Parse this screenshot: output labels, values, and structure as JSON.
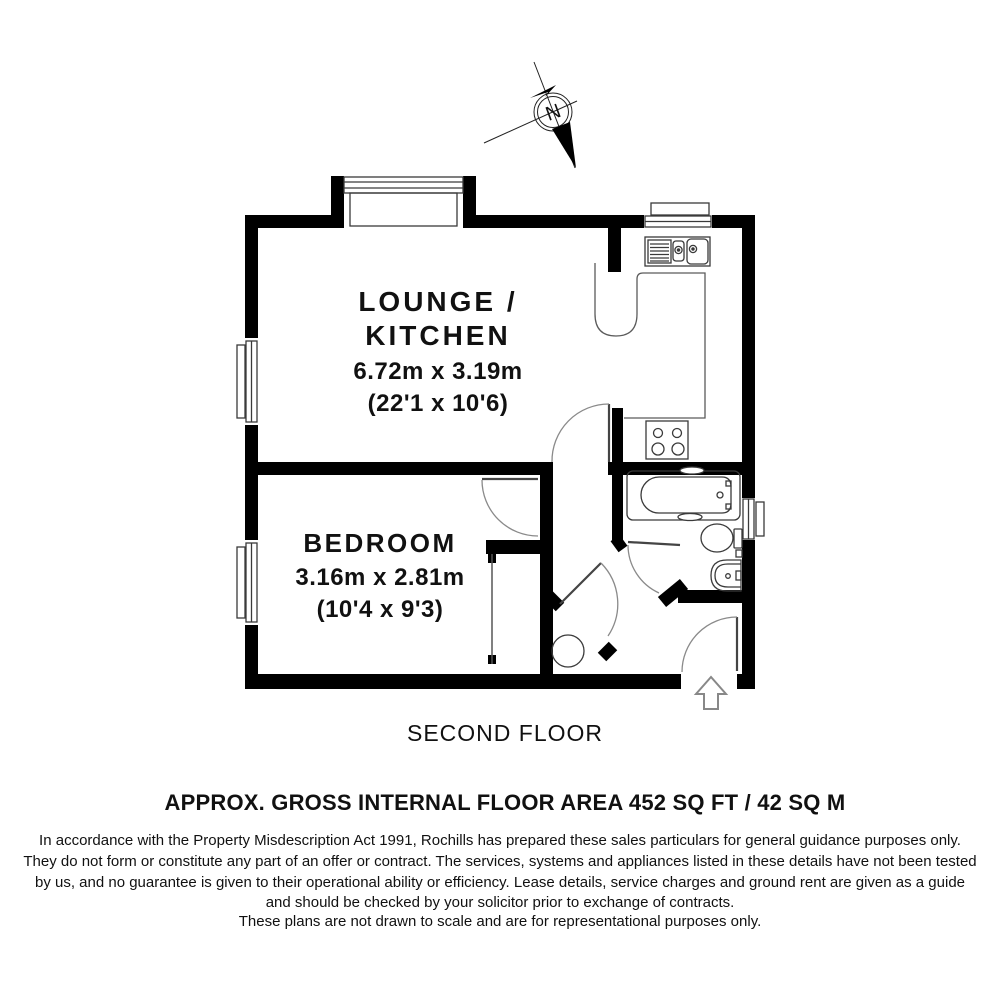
{
  "compass": {
    "north_label": "N"
  },
  "plan": {
    "rooms": {
      "lounge_kitchen": {
        "label_line1": "LOUNGE /",
        "label_line2": "KITCHEN",
        "dimensions_metric": "6.72m x 3.19m",
        "dimensions_imperial": "(22'1 x 10'6)"
      },
      "bedroom": {
        "label": "BEDROOM",
        "dimensions_metric": "3.16m x 2.81m",
        "dimensions_imperial": "(10'4 x 9'3)"
      }
    },
    "floor_label": "SECOND FLOOR"
  },
  "footer": {
    "area_label": "APPROX. GROSS INTERNAL FLOOR AREA 452 SQ FT / 42 SQ M",
    "disclaimer_lines": [
      "In accordance with the Property Misdescription Act 1991, Rochills has prepared these sales particulars for general guidance purposes only.",
      "They do not form or constitute any part of an offer or contract. The services, systems and appliances listed in these details have not been tested",
      "by us, and no guarantee is given to their operational ability or efficiency. Lease details, service charges and ground rent are given as a guide",
      "and should be checked by your solicitor prior to exchange of contracts.",
      "These plans are not drawn to scale and are for representational purposes only."
    ]
  },
  "colors": {
    "wall": "#000000",
    "fixture_line": "#3a3a3a",
    "door_arc": "#8a8a8a",
    "text": "#111111",
    "background": "#ffffff"
  }
}
